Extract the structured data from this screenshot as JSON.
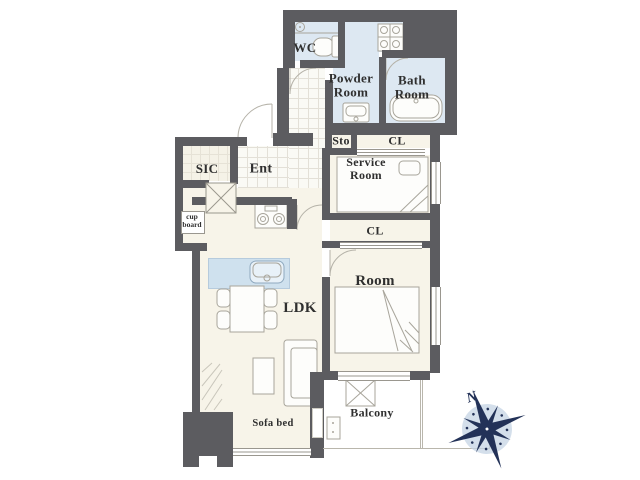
{
  "title": "apartment-floor-plan",
  "labels": {
    "wc": "WC",
    "powder_line1": "Powder",
    "powder_line2": "Room",
    "bath_line1": "Bath",
    "bath_line2": "Room",
    "sto": "Sto",
    "cl_upper": "CL",
    "service_line1": "Service",
    "service_line2": "Room",
    "sic": "SIC",
    "ent": "Ent",
    "cupboard_line1": "cup",
    "cupboard_line2": "board",
    "cl_mid": "CL",
    "room": "Room",
    "ldk": "LDK",
    "balcony": "Balcony",
    "sofa_bed": "Sofa bed",
    "compass_north": "N"
  },
  "icons": {
    "toilet": "toilet-icon",
    "vanity": "vanity-unit-icon",
    "washbasin": "washbasin-icon",
    "bathtub": "bathtub-icon",
    "stove": "two-burner-stove-icon",
    "kitchen_sink": "kitchen-sink-icon",
    "dining_table": "dining-table-icon",
    "sofa": "sofa-icon",
    "beds": "bed-icon",
    "pillar": "pillar-x-icon",
    "hatch": "evacuation-hatch-icon",
    "compass": "compass-rose-icon"
  },
  "colors": {
    "wall": "#5c5c60",
    "floor": "#f7f4e9",
    "wet_area": "#dde8f2",
    "kitchen_counter": "#cfe1ee",
    "compass_navy": "#233258"
  }
}
